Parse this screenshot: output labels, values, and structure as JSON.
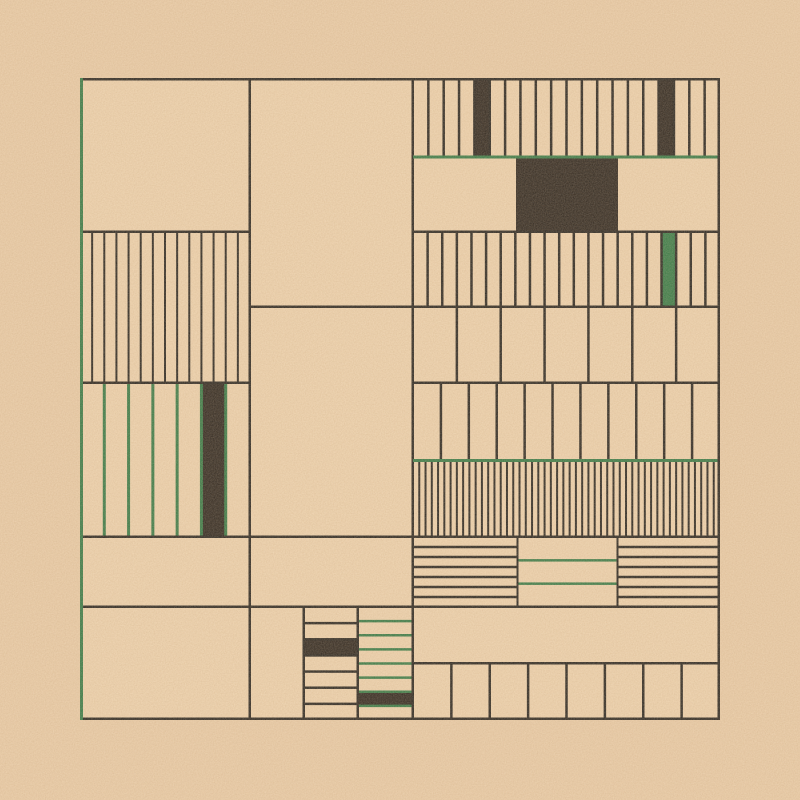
{
  "artwork": {
    "canvas": {
      "width": 800,
      "height": 800
    },
    "palette": {
      "tan_outer": "#eacca7",
      "tan_panel": "#eed2ad",
      "line": "#2e2a24",
      "dark": "#332b23",
      "green": "#3b7c49"
    },
    "frame": {
      "x": 80,
      "y": 78,
      "w": 640,
      "h": 642
    },
    "panels": [
      {
        "name": "left-stripes",
        "x": 80,
        "y": 232,
        "w": 170,
        "h": 151,
        "orientation": "v",
        "count": 14,
        "lw": 2,
        "color": "line",
        "fills": []
      },
      {
        "name": "left-green-stripes",
        "x": 80,
        "y": 383,
        "w": 170,
        "h": 154,
        "orientation": "v",
        "count": 7,
        "lw": 3,
        "color": "green",
        "fills": [
          {
            "i": 5,
            "color": "dark"
          }
        ]
      },
      {
        "name": "top-right-stripes",
        "x": 413,
        "y": 79,
        "w": 307,
        "h": 78,
        "orientation": "v",
        "count": 20,
        "lw": 2.5,
        "color": "line",
        "fills": [
          {
            "i": 4,
            "color": "dark"
          },
          {
            "i": 16,
            "color": "dark"
          }
        ]
      },
      {
        "name": "right-stripes-row3",
        "x": 413,
        "y": 232,
        "w": 307,
        "h": 75,
        "orientation": "v",
        "count": 21,
        "lw": 2.5,
        "color": "line",
        "fills": [
          {
            "i": 17,
            "color": "green"
          }
        ]
      },
      {
        "name": "right-columns-row4",
        "x": 413,
        "y": 307,
        "w": 307,
        "h": 76,
        "orientation": "v",
        "count": 7,
        "lw": 2.5,
        "color": "line",
        "fills": []
      },
      {
        "name": "right-columns-row5",
        "x": 413,
        "y": 383,
        "w": 307,
        "h": 77,
        "orientation": "v",
        "count": 11,
        "lw": 2.5,
        "color": "line",
        "fills": []
      },
      {
        "name": "right-dense-stripes",
        "x": 413,
        "y": 462,
        "w": 307,
        "h": 74,
        "orientation": "v",
        "count": 49,
        "lw": 2,
        "color": "line",
        "fills": []
      },
      {
        "name": "hlines-left-section",
        "x": 413,
        "y": 537,
        "w": 105,
        "h": 70,
        "orientation": "h",
        "count": 7,
        "lw": 2.5,
        "color": "line",
        "fills": []
      },
      {
        "name": "hlines-middle-green-section",
        "x": 518,
        "y": 537,
        "w": 100,
        "h": 70,
        "orientation": "h",
        "count": 3,
        "lw": 2.5,
        "color": "green",
        "fills": []
      },
      {
        "name": "hlines-right-section",
        "x": 618,
        "y": 537,
        "w": 102,
        "h": 70,
        "orientation": "h",
        "count": 7,
        "lw": 2.5,
        "color": "line",
        "fills": []
      },
      {
        "name": "bottom-right-columns",
        "x": 413,
        "y": 663,
        "w": 307,
        "h": 57,
        "orientation": "v",
        "count": 8,
        "lw": 2.5,
        "color": "line",
        "fills": []
      },
      {
        "name": "bottom-middle-hstripes",
        "x": 304,
        "y": 607,
        "w": 54,
        "h": 113,
        "orientation": "h",
        "count": 7,
        "lw": 2.5,
        "color": "line",
        "fills": [
          {
            "i": 2,
            "color": "dark"
          }
        ]
      },
      {
        "name": "bottom-middle-green-hstripes",
        "x": 358,
        "y": 607,
        "w": 55,
        "h": 113,
        "orientation": "h",
        "count": 8,
        "lw": 2.5,
        "color": "green",
        "fills": [
          {
            "i": 6,
            "color": "dark"
          }
        ]
      }
    ],
    "fills": [
      {
        "name": "dark-block",
        "x": 516,
        "y": 157,
        "w": 102,
        "h": 75,
        "color": "dark"
      }
    ],
    "lines": [
      {
        "name": "divider-v-left",
        "x": 248.5,
        "y": 78,
        "w": 2.5,
        "h": 642,
        "color": "line"
      },
      {
        "name": "divider-v-right",
        "x": 411.5,
        "y": 78,
        "w": 2.5,
        "h": 642,
        "color": "line"
      },
      {
        "name": "h-232-left",
        "x": 80,
        "y": 230.5,
        "w": 170,
        "h": 2.5,
        "color": "line"
      },
      {
        "name": "h-232-right",
        "x": 413,
        "y": 230.5,
        "w": 307,
        "h": 2.5,
        "color": "line"
      },
      {
        "name": "h-307",
        "x": 248.5,
        "y": 305.5,
        "w": 471.5,
        "h": 2.5,
        "color": "line"
      },
      {
        "name": "h-383-left",
        "x": 80,
        "y": 381.5,
        "w": 170,
        "h": 2.5,
        "color": "line"
      },
      {
        "name": "h-383-right",
        "x": 413,
        "y": 381.5,
        "w": 307,
        "h": 2.5,
        "color": "line"
      },
      {
        "name": "green-rule-157",
        "x": 413,
        "y": 155.5,
        "w": 307,
        "h": 3,
        "color": "green"
      },
      {
        "name": "green-rule-460",
        "x": 413,
        "y": 459,
        "w": 307,
        "h": 3,
        "color": "green"
      },
      {
        "name": "h-537",
        "x": 80,
        "y": 535.5,
        "w": 640,
        "h": 2.5,
        "color": "line"
      },
      {
        "name": "h-607",
        "x": 80,
        "y": 605.5,
        "w": 640,
        "h": 2.5,
        "color": "line"
      },
      {
        "name": "h-663",
        "x": 413,
        "y": 662,
        "w": 307,
        "h": 2.5,
        "color": "line"
      },
      {
        "name": "v-304",
        "x": 302.5,
        "y": 607,
        "w": 2.5,
        "h": 113,
        "color": "line"
      },
      {
        "name": "v-358",
        "x": 356.5,
        "y": 607,
        "w": 2.5,
        "h": 113,
        "color": "line"
      },
      {
        "name": "v-518",
        "x": 516.5,
        "y": 537,
        "w": 2,
        "h": 70,
        "color": "line"
      },
      {
        "name": "v-618",
        "x": 616.5,
        "y": 537,
        "w": 2,
        "h": 70,
        "color": "line"
      },
      {
        "name": "frame-top",
        "x": 80,
        "y": 78,
        "w": 640,
        "h": 2.5,
        "color": "line"
      },
      {
        "name": "frame-bottom",
        "x": 80,
        "y": 717.5,
        "w": 640,
        "h": 2.5,
        "color": "line"
      },
      {
        "name": "frame-right",
        "x": 717.5,
        "y": 78,
        "w": 2.5,
        "h": 642,
        "color": "line"
      },
      {
        "name": "frame-left",
        "x": 80,
        "y": 78,
        "w": 3,
        "h": 642,
        "color": "green"
      }
    ]
  }
}
